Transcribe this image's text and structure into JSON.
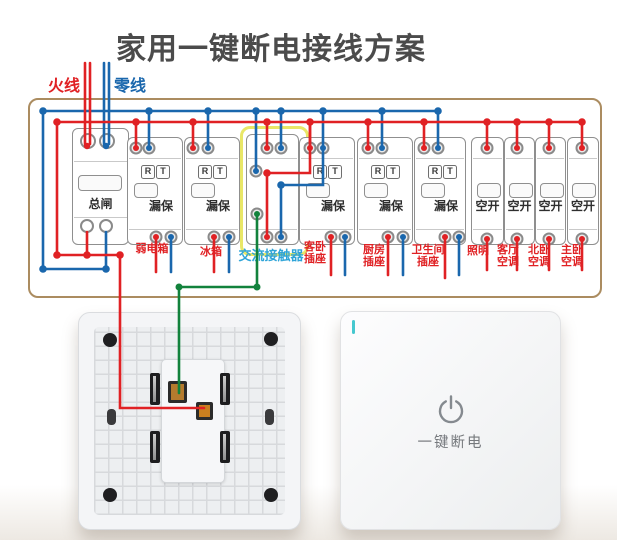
{
  "title": "家用一键断电接线方案",
  "legend": {
    "live": "火线",
    "neutral": "零线"
  },
  "colors": {
    "live_wire": "#e02124",
    "neutral_wire": "#1a67ad",
    "control_wire": "#12823c",
    "panel_border": "#ab8c60",
    "contactor_highlight": "#e9e767",
    "circuit_label": "#e02124",
    "contactor_label": "#2ea4d8",
    "title_text": "#4b4b4b"
  },
  "panel": {
    "modules": [
      {
        "type": "main-breaker",
        "label": "总闸"
      },
      {
        "type": "rcbo",
        "label": "漏保",
        "reset": "R",
        "test": "T"
      },
      {
        "type": "rcbo",
        "label": "漏保",
        "reset": "R",
        "test": "T"
      },
      {
        "type": "ac-contactor"
      },
      {
        "type": "rcbo",
        "label": "漏保",
        "reset": "R",
        "test": "T"
      },
      {
        "type": "rcbo",
        "label": "漏保",
        "reset": "R",
        "test": "T"
      },
      {
        "type": "rcbo",
        "label": "漏保",
        "reset": "R",
        "test": "T"
      },
      {
        "type": "mcb",
        "label": "空开"
      },
      {
        "type": "mcb",
        "label": "空开"
      },
      {
        "type": "mcb",
        "label": "空开"
      },
      {
        "type": "mcb",
        "label": "空开"
      }
    ]
  },
  "circuits": [
    {
      "line1": "弱电箱"
    },
    {
      "line1": "冰箱"
    },
    {
      "line1": "交流接触器"
    },
    {
      "line1": "客卧",
      "line2": "插座"
    },
    {
      "line1": "厨房",
      "line2": "插座"
    },
    {
      "line1": "卫生间",
      "line2": "插座"
    },
    {
      "line1": "照明"
    },
    {
      "line1": "客厅",
      "line2": "空调"
    },
    {
      "line1": "北卧",
      "line2": "空调"
    },
    {
      "line1": "主卧",
      "line2": "空调"
    }
  ],
  "onekey_switch": {
    "label": "一键断电"
  }
}
